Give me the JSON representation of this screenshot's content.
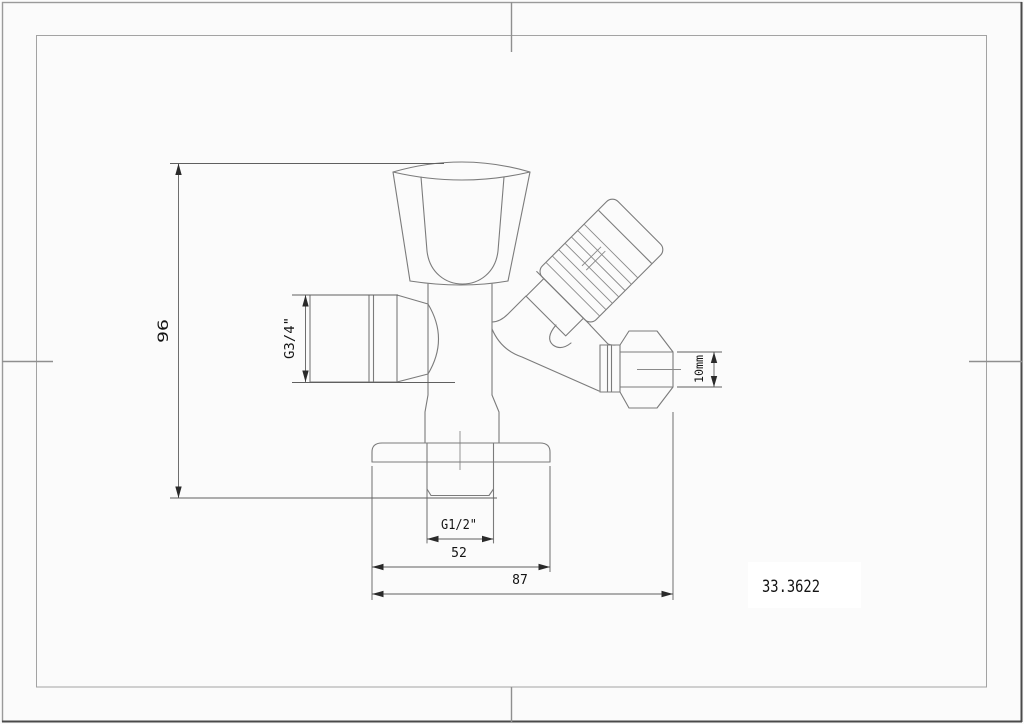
{
  "sheet": {
    "part_number": "33.3622"
  },
  "dimensions": {
    "overall_height": "96",
    "left_port_thread": "G3/4\"",
    "outlet_width": "10mm",
    "bottom_thread": "G1/2\"",
    "body_width": "52",
    "overall_width": "87"
  },
  "colors": {
    "page_bg": "#f9f9f9",
    "sheet_bg": "#fbfbfb",
    "line": "#7b7b7b",
    "dimension_line": "#5f5f5f",
    "text": "#141414",
    "frame": "#a3a3a3",
    "part_box_bg": "#ffffff"
  }
}
